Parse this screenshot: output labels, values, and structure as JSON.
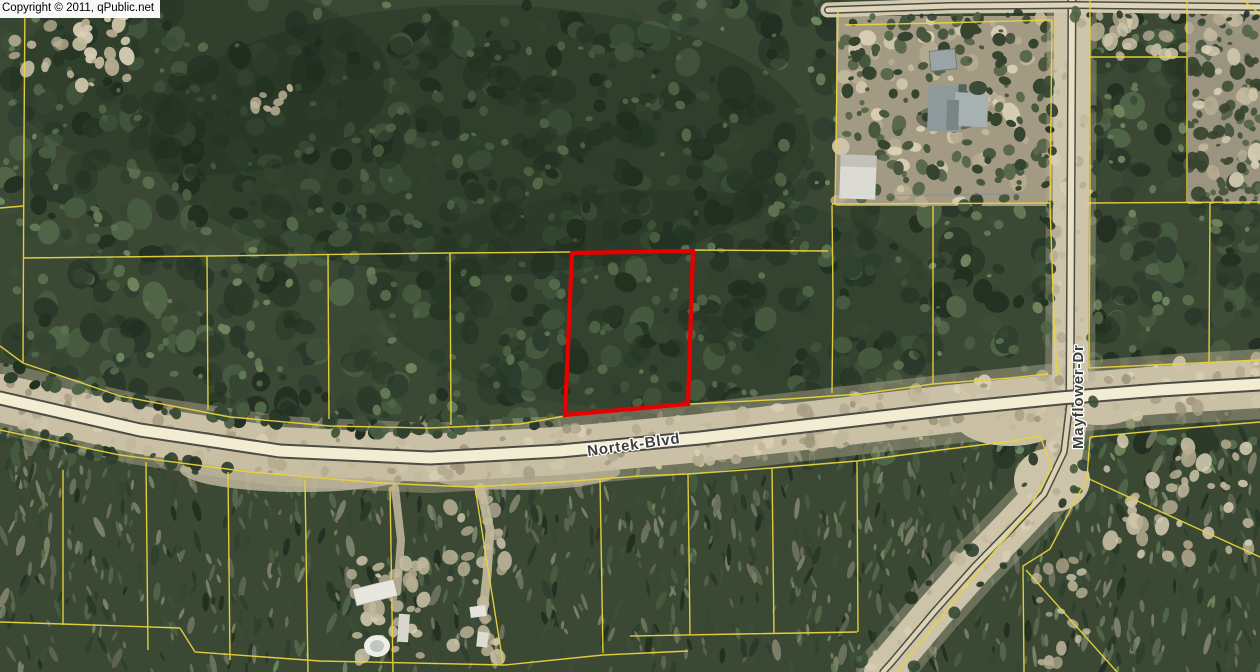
{
  "copyright": {
    "text": "Copyright © 2011, qPublic.net"
  },
  "roads": {
    "nortek_blvd": {
      "label": "Nortek-Blvd"
    },
    "mayflower_dr": {
      "label": "Mayflower-Dr"
    }
  },
  "parcels": {
    "boundary_color": "#e9d43e",
    "selected": {
      "outline_color": "#e80000"
    }
  }
}
